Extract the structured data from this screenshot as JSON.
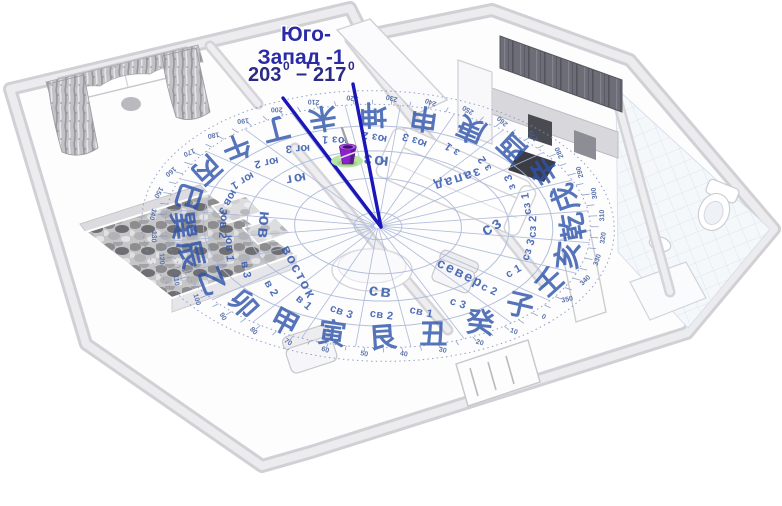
{
  "annotation": {
    "line1": "Юго-",
    "line2": "Запад -1",
    "range_from": "203",
    "range_sup": "0",
    "range_sep": "–",
    "range_to": "217"
  },
  "marker": {
    "icon": "mop-bucket",
    "colors": {
      "bucket": "#8b22cc",
      "bucket_dark": "#5e1795",
      "bucket_rim": "#b357ee",
      "grass": "#b9e4a4"
    }
  },
  "compass": {
    "mountains": [
      "子",
      "癸",
      "丑",
      "艮",
      "寅",
      "甲",
      "卯",
      "乙",
      "辰",
      "巽",
      "巳",
      "丙",
      "午",
      "丁",
      "未",
      "坤",
      "申",
      "庚",
      "酉",
      "辛",
      "戌",
      "乾",
      "亥",
      "壬"
    ],
    "sector_labels": [
      "с 2",
      "с 3",
      "св 1",
      "св 2",
      "св 3",
      "в 1",
      "в 2",
      "в 3",
      "юв 1",
      "юв 2",
      "юв 3",
      "юг 1",
      "юг 2",
      "юг 3",
      "юз 1",
      "юз 2",
      "юз 3",
      "з 1",
      "з 2",
      "з 3",
      "сз 1",
      "сз 2",
      "сз 3",
      "с 1"
    ],
    "directions": [
      {
        "label": "север",
        "az": 0
      },
      {
        "label": "св",
        "az": 45
      },
      {
        "label": "восток",
        "az": 90
      },
      {
        "label": "юв",
        "az": 135
      },
      {
        "label": "юг",
        "az": 180
      },
      {
        "label": "юз",
        "az": 225
      },
      {
        "label": "запад",
        "az": 270
      },
      {
        "label": "сз",
        "az": 315
      }
    ],
    "degree_labels": [
      0,
      10,
      20,
      30,
      40,
      50,
      60,
      70,
      80,
      90,
      100,
      110,
      120,
      130,
      140,
      150,
      160,
      170,
      180,
      190,
      200,
      210,
      220,
      230,
      240,
      250,
      260,
      270,
      280,
      290,
      300,
      310,
      320,
      330,
      340,
      350
    ],
    "colors": {
      "text_blue": "#2e54ab",
      "ring_line": "#a9b7d8",
      "tick_line": "#7f95c2",
      "degree_num": "#46639f",
      "title_blue": "#2b2ba8",
      "range_blue": "#2b2b86",
      "sector_line_blue": "#1a16b8"
    }
  }
}
